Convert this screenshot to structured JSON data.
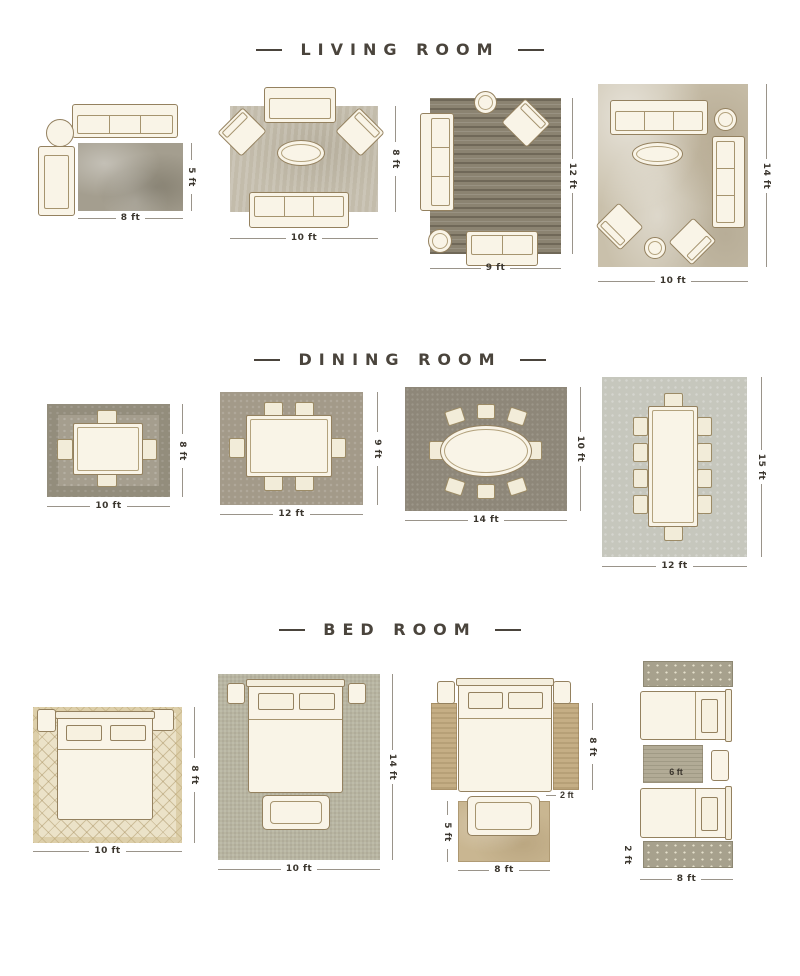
{
  "palette": {
    "background": "#ffffff",
    "title_text": "#4a443c",
    "furniture_fill": "#f9f4e7",
    "furniture_outline": "#94815f",
    "dimension_line": "#9a948a",
    "dimension_text": "#3b362e",
    "rug_gray": "#a49e8f",
    "rug_taupe": "#c3bcab",
    "rug_dark": "#8b8371",
    "rug_marble": "#c9c0ab",
    "rug_cream_diamond": "#ebe2c8",
    "rug_sage": "#b8b5a1",
    "rug_tan": "#c5ae85"
  },
  "sections": {
    "living": {
      "title": "LIVING ROOM",
      "layouts": [
        {
          "width": "8 ft",
          "height": "5 ft"
        },
        {
          "width": "10 ft",
          "height": "8 ft"
        },
        {
          "width": "9 ft",
          "height": "12 ft"
        },
        {
          "width": "10 ft",
          "height": "14 ft"
        }
      ]
    },
    "dining": {
      "title": "DINING ROOM",
      "layouts": [
        {
          "width": "10 ft",
          "height": "8 ft"
        },
        {
          "width": "12 ft",
          "height": "9 ft"
        },
        {
          "width": "14 ft",
          "height": "10 ft"
        },
        {
          "width": "12 ft",
          "height": "15 ft"
        }
      ]
    },
    "bedroom": {
      "title": "BED ROOM",
      "layouts": [
        {
          "width": "10 ft",
          "height": "8 ft"
        },
        {
          "width": "10 ft",
          "height": "14 ft"
        },
        {
          "bed_height": "8 ft",
          "runner_width": "2 ft",
          "bench_rug_width": "8 ft",
          "bench_rug_height": "5 ft"
        },
        {
          "width": "8 ft",
          "runner_height": "2 ft",
          "between_rug": "6 ft"
        }
      ]
    }
  }
}
